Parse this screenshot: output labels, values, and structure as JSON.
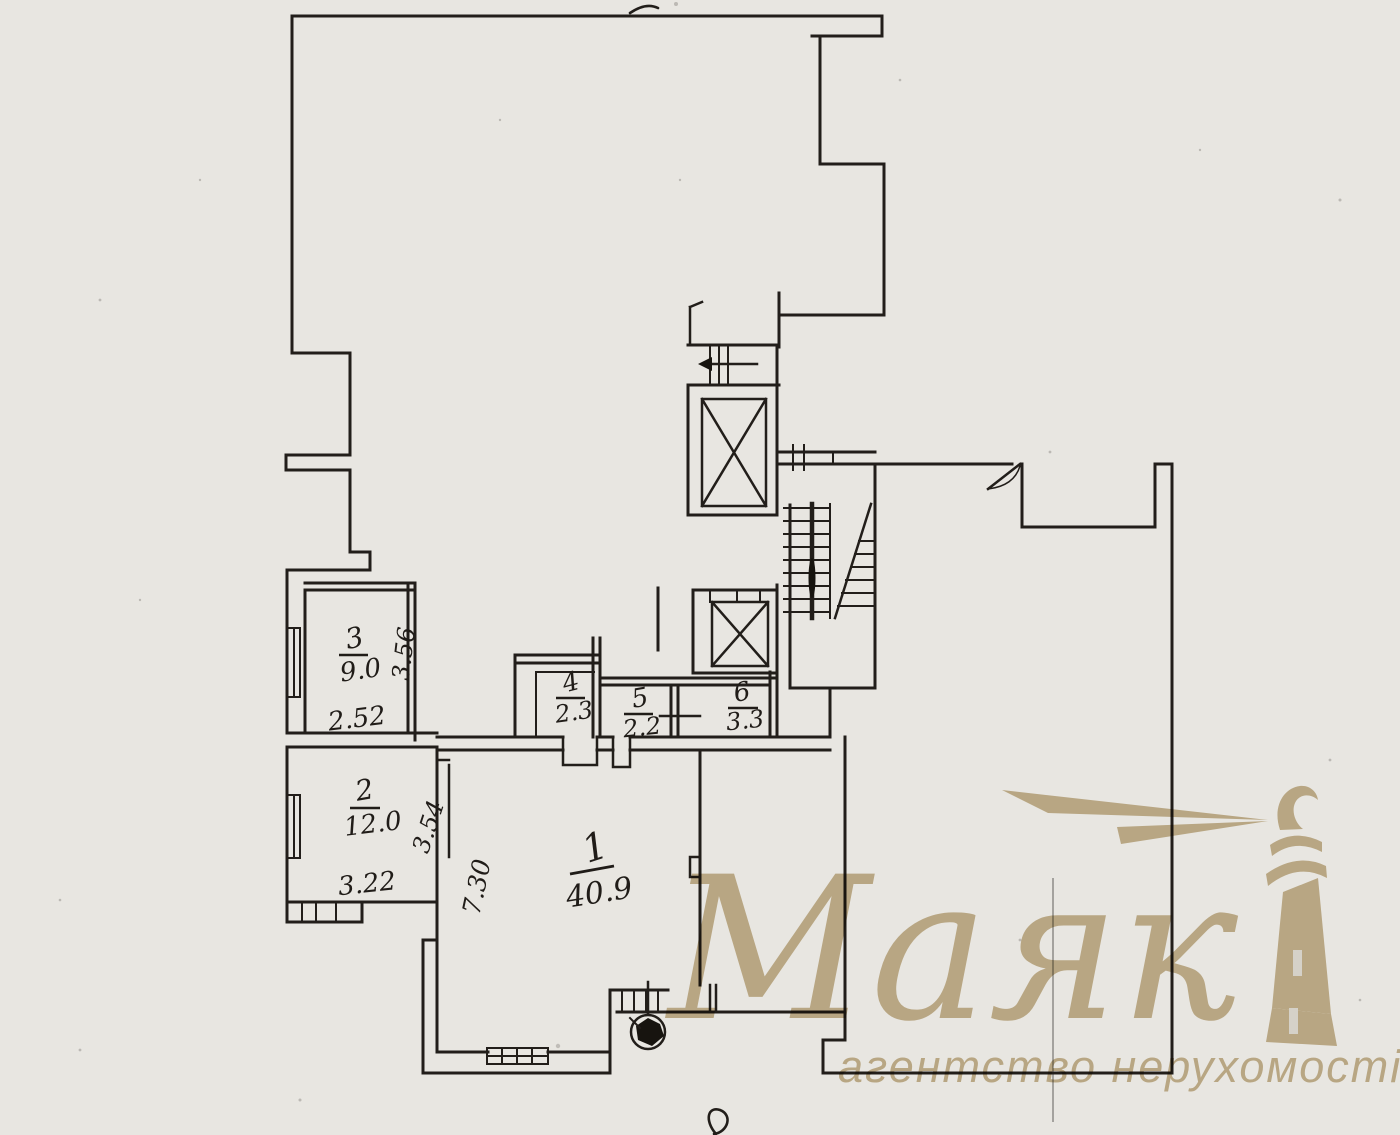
{
  "page": {
    "background": "#e8e6e1",
    "ink": "#221e1a"
  },
  "watermark": {
    "brand": "Маяк",
    "tagline": "агентство нерухомості",
    "color": "#c6b28a"
  },
  "plan": {
    "rooms": [
      {
        "number": "1",
        "area": "40.9"
      },
      {
        "number": "2",
        "area": "12.0"
      },
      {
        "number": "3",
        "area": "9.0"
      },
      {
        "number": "4",
        "area": "2.3"
      },
      {
        "number": "5",
        "area": "2.2"
      },
      {
        "number": "6",
        "area": "3.3"
      }
    ],
    "dimensions": {
      "room1_depth": "7.30",
      "room2_width": "3.22",
      "room2_depth": "3.54",
      "room3_width": "2.52",
      "room3_depth": "3.56"
    },
    "symbols": {
      "elevator_shaft_upper": "crossed-box",
      "elevator_shaft_lower": "crossed-box",
      "staircase": "flight-with-diagonal",
      "entry_arrow": "left-arrow",
      "door_swing": "quarter-arc",
      "window": "hatched-band",
      "plumbing_fixture": "circle-with-blob"
    }
  }
}
